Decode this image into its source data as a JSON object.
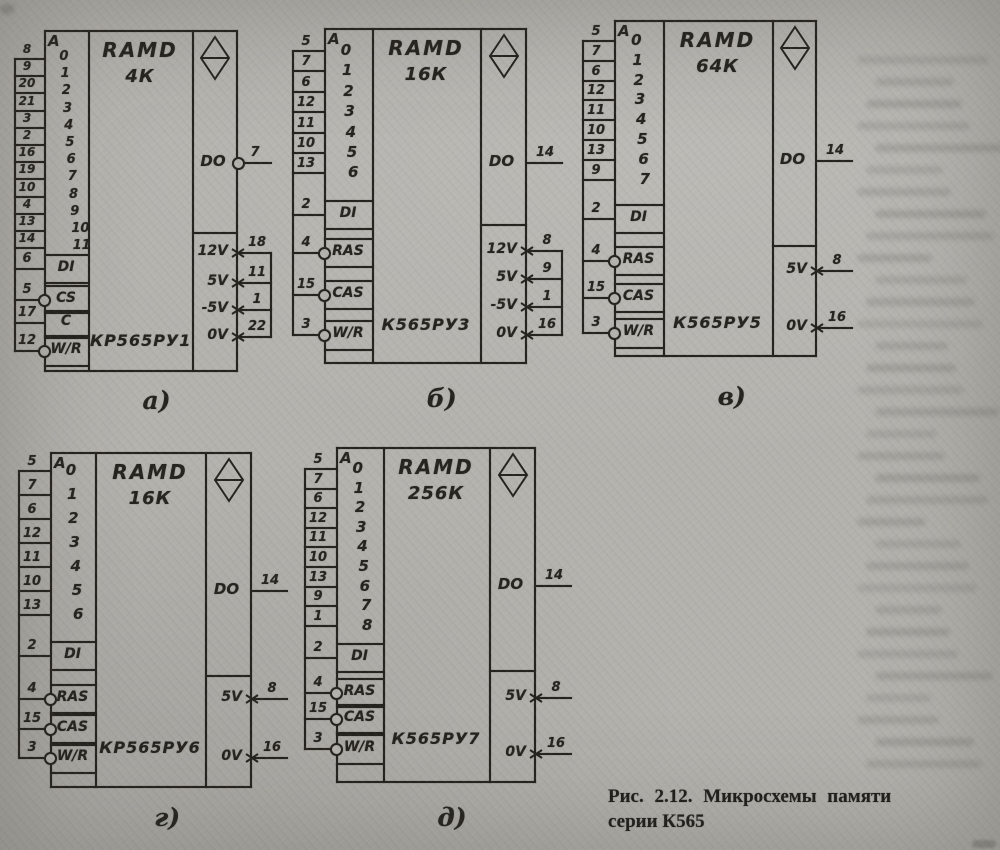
{
  "figure": {
    "caption_line1": "Рис. 2.12. Микросхемы памяти",
    "caption_line2": "серии К565"
  },
  "chips": [
    {
      "label": "а)",
      "title": "RAMD",
      "capacity": "4К",
      "name": "КР565РУ1",
      "addr": {
        "header": "A",
        "rows": [
          {
            "digit": "0",
            "pin": "8"
          },
          {
            "digit": "1",
            "pin": "9"
          },
          {
            "digit": "2",
            "pin": "20"
          },
          {
            "digit": "3",
            "pin": "21"
          },
          {
            "digit": "4",
            "pin": "3"
          },
          {
            "digit": "5",
            "pin": "2"
          },
          {
            "digit": "6",
            "pin": "16"
          },
          {
            "digit": "7",
            "pin": "19"
          },
          {
            "digit": "8",
            "pin": "10"
          },
          {
            "digit": "9",
            "pin": "4"
          },
          {
            "digit": "10",
            "pin": "13"
          },
          {
            "digit": "11",
            "pin": "14"
          }
        ]
      },
      "controls": [
        {
          "label": "DI",
          "pin": "6",
          "circle": false
        },
        {
          "label": "CS",
          "pin": "5",
          "circle": true
        },
        {
          "label": "C",
          "pin": "17",
          "circle": false
        },
        {
          "label": "W/R",
          "pin": "12",
          "circle": true
        }
      ],
      "dout": {
        "label": "DO",
        "pin": "7",
        "circle": true
      },
      "power": [
        {
          "label": "12V",
          "pin": "18"
        },
        {
          "label": "5V",
          "pin": "11"
        },
        {
          "label": "-5V",
          "pin": "1"
        },
        {
          "label": "0V",
          "pin": "22"
        }
      ]
    },
    {
      "label": "б)",
      "title": "RAMD",
      "capacity": "16К",
      "name": "К565РУ3",
      "addr": {
        "header": "A",
        "rows": [
          {
            "digit": "0",
            "pin": "5"
          },
          {
            "digit": "1",
            "pin": "7"
          },
          {
            "digit": "2",
            "pin": "6"
          },
          {
            "digit": "3",
            "pin": "12"
          },
          {
            "digit": "4",
            "pin": "11"
          },
          {
            "digit": "5",
            "pin": "10"
          },
          {
            "digit": "6",
            "pin": "13"
          }
        ]
      },
      "controls": [
        {
          "label": "DI",
          "pin": "2",
          "circle": false
        },
        {
          "label": "RAS",
          "pin": "4",
          "circle": true
        },
        {
          "label": "CAS",
          "pin": "15",
          "circle": true
        },
        {
          "label": "W/R",
          "pin": "3",
          "circle": true
        }
      ],
      "dout": {
        "label": "DO",
        "pin": "14",
        "circle": false
      },
      "power": [
        {
          "label": "12V",
          "pin": "8"
        },
        {
          "label": "5V",
          "pin": "9"
        },
        {
          "label": "-5V",
          "pin": "1"
        },
        {
          "label": "0V",
          "pin": "16"
        }
      ]
    },
    {
      "label": "в)",
      "title": "RAMD",
      "capacity": "64К",
      "name": "К565РУ5",
      "addr": {
        "header": "A",
        "rows": [
          {
            "digit": "0",
            "pin": "5"
          },
          {
            "digit": "1",
            "pin": "7"
          },
          {
            "digit": "2",
            "pin": "6"
          },
          {
            "digit": "3",
            "pin": "12"
          },
          {
            "digit": "4",
            "pin": "11"
          },
          {
            "digit": "5",
            "pin": "10"
          },
          {
            "digit": "6",
            "pin": "13"
          },
          {
            "digit": "7",
            "pin": "9"
          }
        ]
      },
      "controls": [
        {
          "label": "DI",
          "pin": "2",
          "circle": false
        },
        {
          "label": "RAS",
          "pin": "4",
          "circle": true
        },
        {
          "label": "CAS",
          "pin": "15",
          "circle": true
        },
        {
          "label": "W/R",
          "pin": "3",
          "circle": true
        }
      ],
      "dout": {
        "label": "DO",
        "pin": "14",
        "circle": false
      },
      "power": [
        {
          "label": "5V",
          "pin": "8"
        },
        {
          "label": "0V",
          "pin": "16"
        }
      ]
    },
    {
      "label": "г)",
      "title": "RAMD",
      "capacity": "16К",
      "name": "КР565РУ6",
      "addr": {
        "header": "A",
        "rows": [
          {
            "digit": "0",
            "pin": "5"
          },
          {
            "digit": "1",
            "pin": "7"
          },
          {
            "digit": "2",
            "pin": "6"
          },
          {
            "digit": "3",
            "pin": "12"
          },
          {
            "digit": "4",
            "pin": "11"
          },
          {
            "digit": "5",
            "pin": "10"
          },
          {
            "digit": "6",
            "pin": "13"
          }
        ]
      },
      "controls": [
        {
          "label": "DI",
          "pin": "2",
          "circle": false
        },
        {
          "label": "RAS",
          "pin": "4",
          "circle": true
        },
        {
          "label": "CAS",
          "pin": "15",
          "circle": true
        },
        {
          "label": "W/R",
          "pin": "3",
          "circle": true
        }
      ],
      "dout": {
        "label": "DO",
        "pin": "14",
        "circle": false
      },
      "power": [
        {
          "label": "5V",
          "pin": "8"
        },
        {
          "label": "0V",
          "pin": "16"
        }
      ]
    },
    {
      "label": "д)",
      "title": "RAMD",
      "capacity": "256К",
      "name": "К565РУ7",
      "addr": {
        "header": "A",
        "rows": [
          {
            "digit": "0",
            "pin": "5"
          },
          {
            "digit": "1",
            "pin": "7"
          },
          {
            "digit": "2",
            "pin": "6"
          },
          {
            "digit": "3",
            "pin": "12"
          },
          {
            "digit": "4",
            "pin": "11"
          },
          {
            "digit": "5",
            "pin": "10"
          },
          {
            "digit": "6",
            "pin": "13"
          },
          {
            "digit": "7",
            "pin": "9"
          },
          {
            "digit": "8",
            "pin": "1"
          }
        ]
      },
      "controls": [
        {
          "label": "DI",
          "pin": "2",
          "circle": false
        },
        {
          "label": "RAS",
          "pin": "4",
          "circle": true
        },
        {
          "label": "CAS",
          "pin": "15",
          "circle": true
        },
        {
          "label": "W/R",
          "pin": "3",
          "circle": true
        }
      ],
      "dout": {
        "label": "DO",
        "pin": "14",
        "circle": false
      },
      "power": [
        {
          "label": "5V",
          "pin": "8"
        },
        {
          "label": "0V",
          "pin": "16"
        }
      ]
    }
  ]
}
